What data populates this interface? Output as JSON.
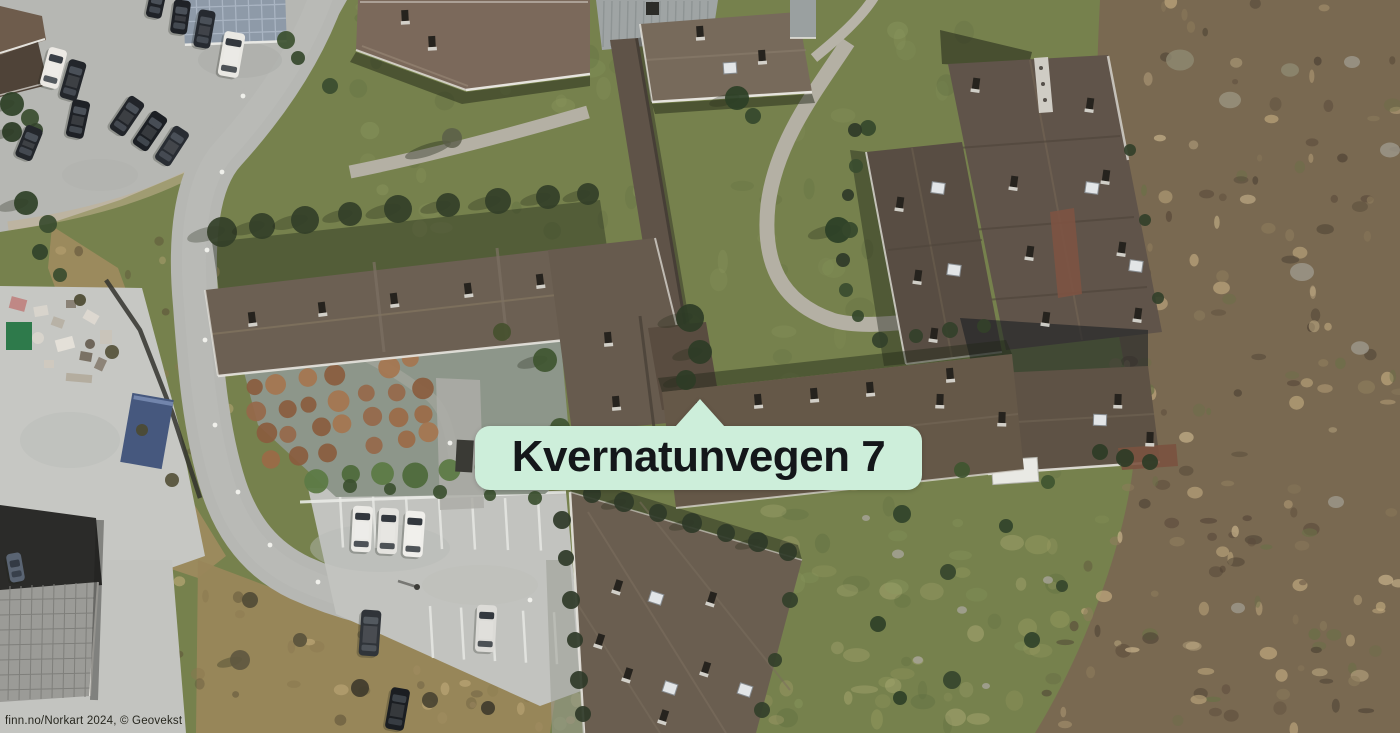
{
  "map": {
    "address_label": "Kvernatunvegen 7",
    "attribution": "finn.no/Norkart 2024, © Geovekst",
    "colors": {
      "label_bg": "#cdeeda",
      "label_text": "#14171a",
      "attribution_text": "#27271f",
      "grass": "#76814d",
      "heath": "#796951",
      "asphalt": "#b6b7b3",
      "parking": "#c2c3bf",
      "roof_brown": "#675b4e"
    }
  }
}
